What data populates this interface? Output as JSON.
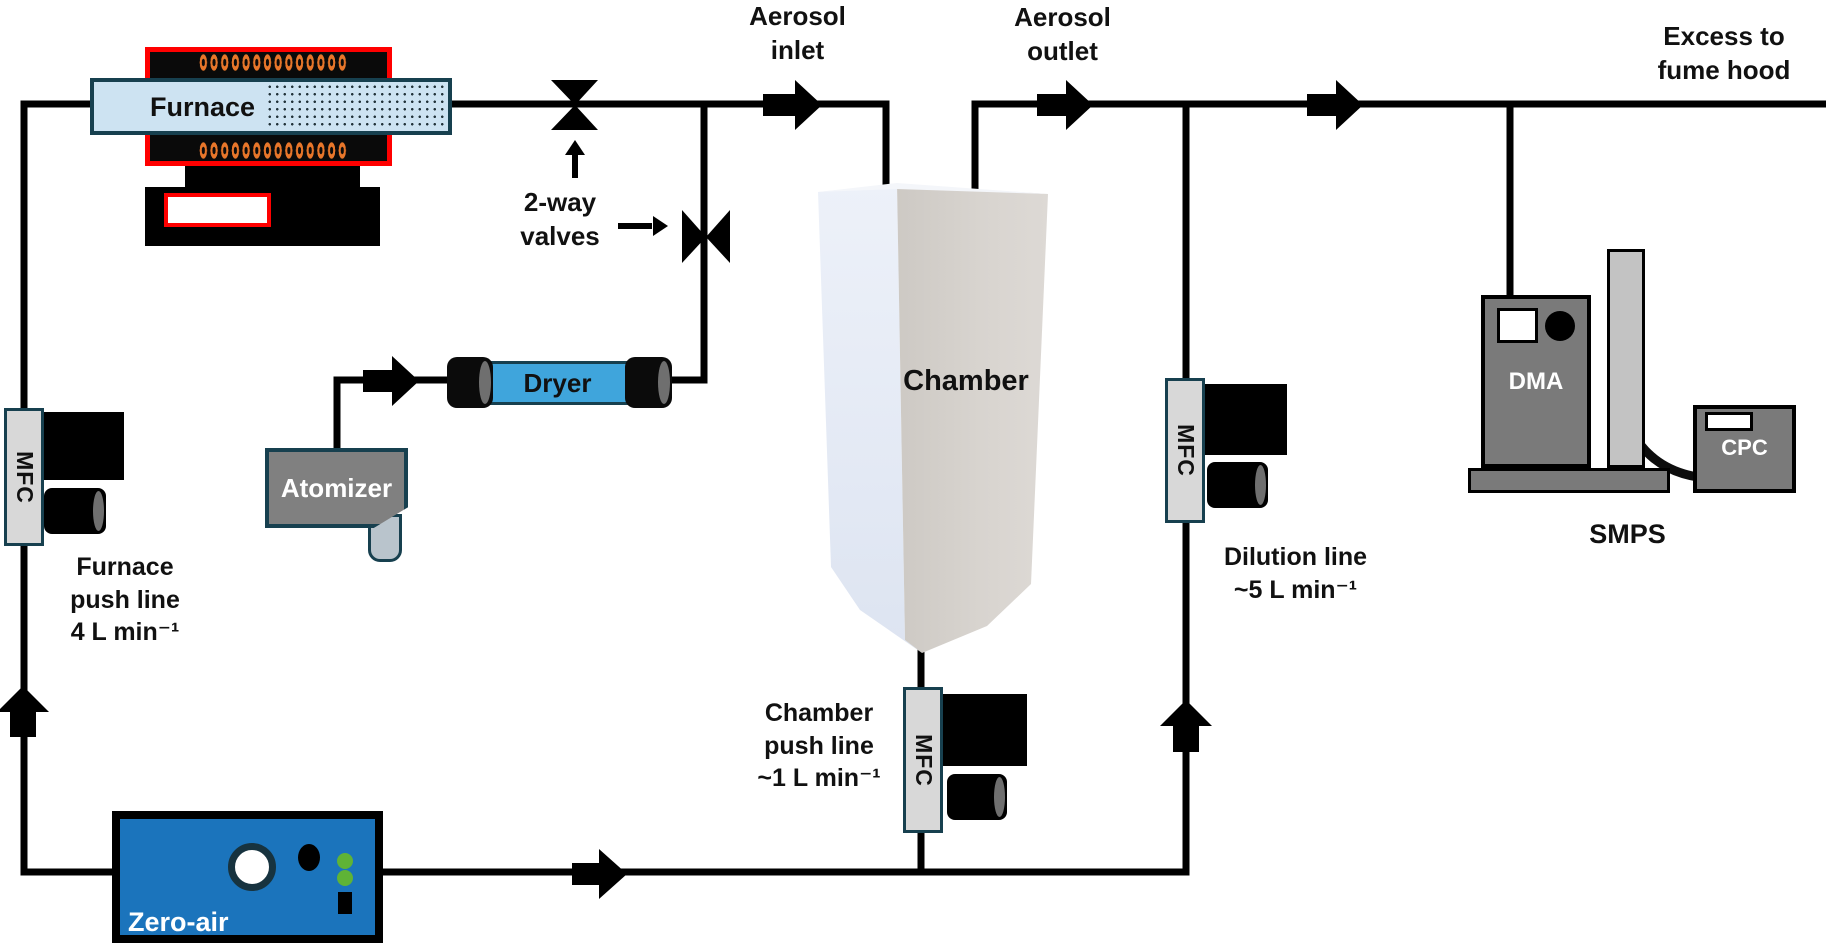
{
  "title": "Aerosol chamber experiment flow diagram",
  "labels": {
    "furnace": "Furnace",
    "two_way_valves": "2-way\nvalves",
    "aerosol_inlet": "Aerosol\ninlet",
    "aerosol_outlet": "Aerosol\noutlet",
    "excess": "Excess to\nfume hood",
    "chamber": "Chamber",
    "dryer": "Dryer",
    "atomizer": "Atomizer",
    "zero_air": "Zero-air",
    "mfc": "MFC",
    "dma": "DMA",
    "cpc": "CPC",
    "smps": "SMPS",
    "furnace_push": "Furnace\npush line\n4 L min⁻¹",
    "chamber_push": "Chamber\npush line\n~1 L min⁻¹",
    "dilution": "Dilution line\n~5 L min⁻¹"
  },
  "colors": {
    "line": "#000000",
    "heater_border": "#ff0000",
    "coil": "#e8762a",
    "tube_fill": "#cde3f2",
    "dark_border": "#17404f",
    "dryer_fill": "#3fa5dc",
    "screen_fill": "#a9cbe8",
    "mfc_fill": "#d8d8d8",
    "zero_air_fill": "#1b74bc",
    "green_led": "#5fb336",
    "instrument_gray": "#7a7a7a",
    "column_gray": "#c3c3c3",
    "chamber_left_face": "#e9eef8",
    "chamber_right_face": "#d5d1cc"
  }
}
